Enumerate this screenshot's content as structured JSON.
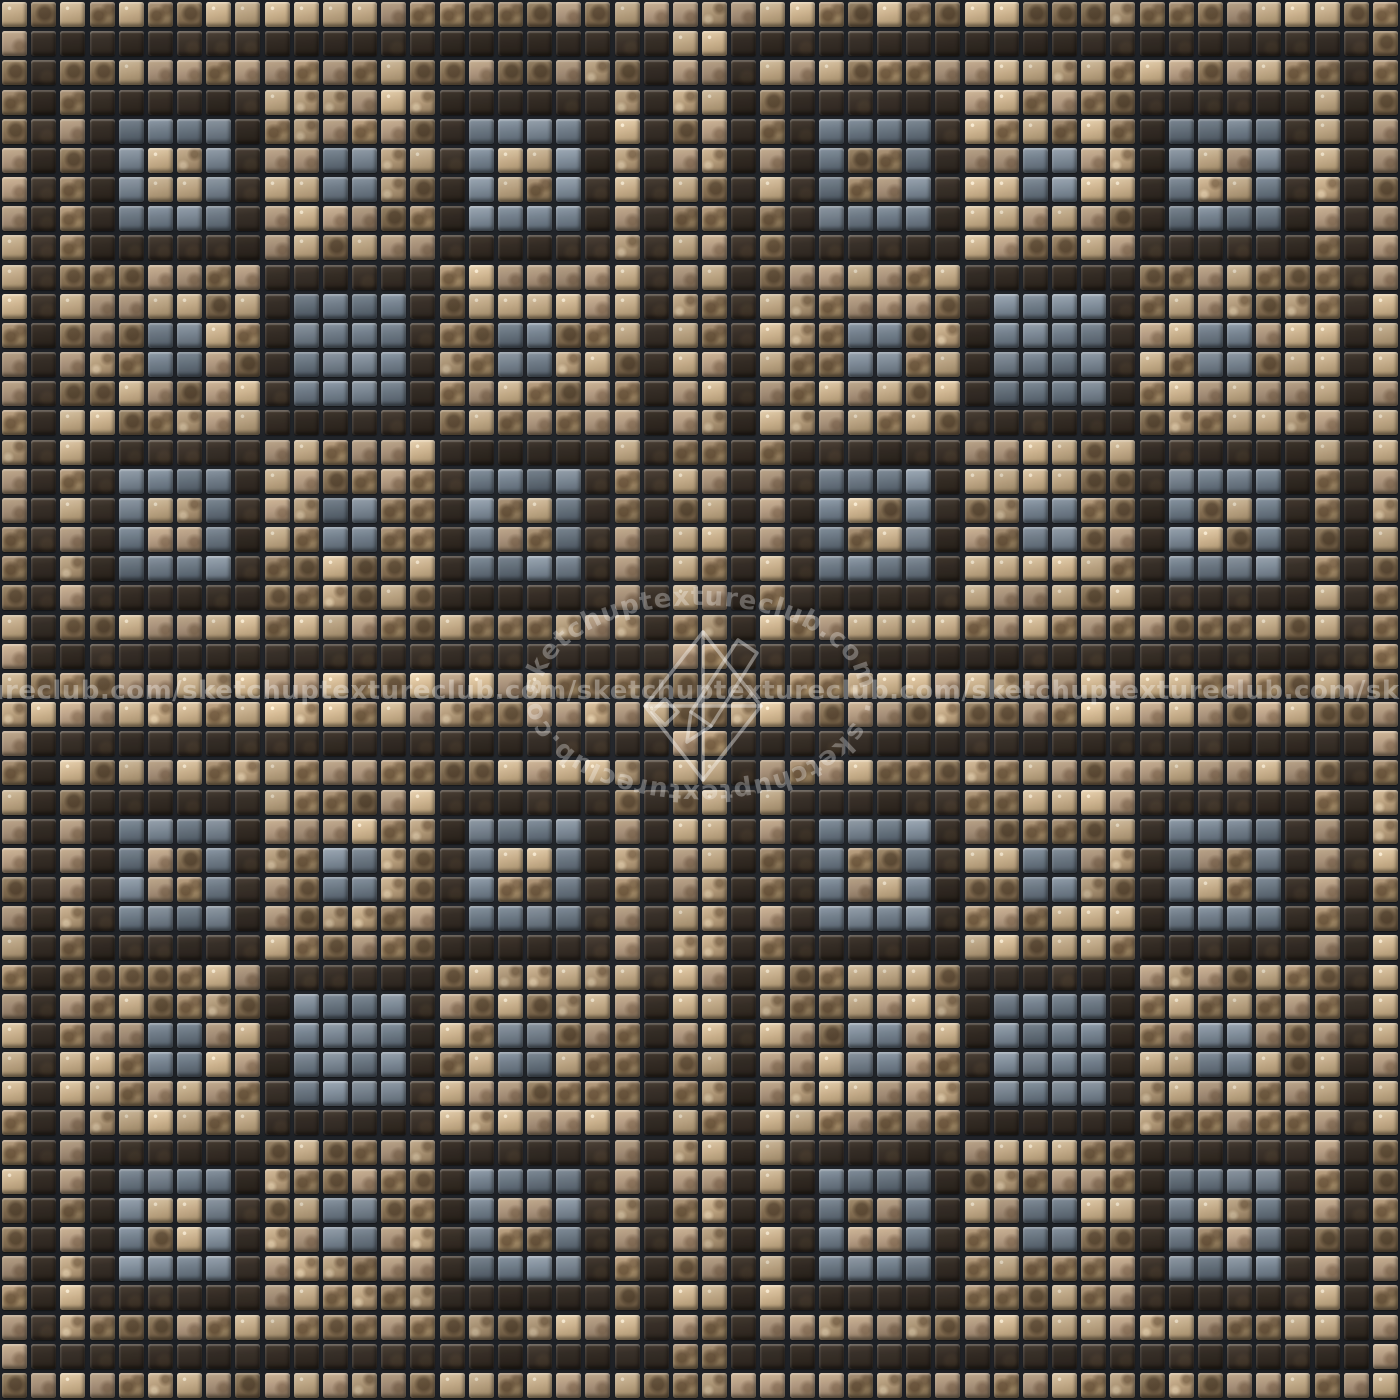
{
  "mosaic": {
    "grid": {
      "rows": 48,
      "cols": 48,
      "cell_px": 29.1667,
      "tile_px": 25,
      "grout_px": 4.17,
      "quadrant_tiles": 24
    },
    "legend": {
      "T": "bronze-tan tile",
      "D": "dark-brown tile",
      "B": "slate-blue tile"
    },
    "quadrant_pattern": [
      "TTTTTTTTTTTTTTTTTTTTTTTT",
      "TDDDDDDDDDDDDDDDDDDDDDDT",
      "TDTTTTTTTTTTTTTTTTTTTTDT",
      "TDTDDDDDDTTTTTTDDDDDDTDT",
      "TDTDBBBBDTTTTTTDBBBBDTDT",
      "TDTDBTTBDTTBBTTDBTTBDTDT",
      "TDTDBTTBDTTBBTTDBTTBDTDT",
      "TDTDBBBBDTTTTTTDBBBBDTDT",
      "TDTDDDDDDTTTTTTDDDDDDTDT",
      "TDTTTTTTTDDDDDDTTTTTTTDT",
      "TDTTTTTTTDBBBBDTTTTTTTDT",
      "TDTTTBBTTDBBBBDTTBBTTTDT",
      "TDTTTBBTTDBBBBDTTBBTTTDT",
      "TDTTTTTTTDBBBBDTTTTTTTDT",
      "TDTTTTTTTDDDDDDTTTTTTTDT",
      "TDTDDDDDDTTTTTTDDDDDDTDT",
      "TDTDBBBBDTTTTTTDBBBBDTDT",
      "TDTDBTTBDTTBBTTDBTTBDTDT",
      "TDTDBTTBDTTBBTTDBTTBDTDT",
      "TDTDBBBBDTTTTTTDBBBBDTDT",
      "TDTDDDDDDTTTTTTDDDDDDTDT",
      "TDTTTTTTTTTTTTTTTTTTTTDT",
      "TDDDDDDDDDDDDDDDDDDDDDDT",
      "TTTTTTTTTTTTTTTTTTTTTTTT"
    ],
    "colors": {
      "grout": "#1e2126",
      "tan_light": "#d6c2a4",
      "tan_base": "#a8917a",
      "tan_dark": "#7e6a4e",
      "tan_speckle": "#4a3826",
      "dark_light": "#483e34",
      "dark_base": "#342d26",
      "dark_deep": "#261f1a",
      "blue_light": "#8c98a4",
      "blue_base": "#6b7784",
      "blue_dark": "#4a545f"
    }
  },
  "watermark": {
    "brand": "sketchuptextureclub.com",
    "horizontal_text": "ureclub.com/sketchuptextureclub.com/sketchuptextureclub.com/sketchuptextureclub.com/sketchuptextureclub.com",
    "ring_text": "sketchuptextureclub.com · sketchuptextureclub.com ·",
    "text_color": "rgba(255,255,255,0.32)"
  }
}
